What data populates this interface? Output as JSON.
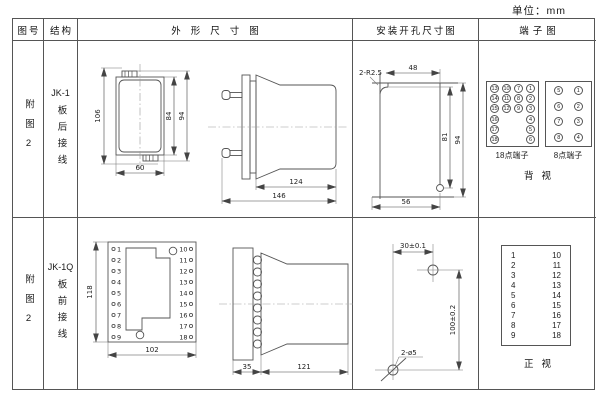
{
  "unit_label": "单位：mm",
  "headers": {
    "fig_no": "图号",
    "structure": "结构",
    "outline": "外形尺寸图",
    "install": "安装开孔尺寸图",
    "terminal": "端子图"
  },
  "row1": {
    "fig_no": "附图2",
    "model": "JK-1",
    "wiring": "板后接线",
    "front": {
      "h106": "106",
      "h84": "84",
      "h94": "94",
      "w60": "60"
    },
    "side": {
      "d124": "124",
      "d146": "146"
    },
    "install": {
      "radius_label": "2-R2.5",
      "d48": "48",
      "d81": "81",
      "d94": "94",
      "d56": "56"
    },
    "t18": {
      "label": "18点端子",
      "grid": [
        [
          "13",
          "10",
          "7",
          "1"
        ],
        [
          "14",
          "11",
          "8",
          "2"
        ],
        [
          "15",
          "12",
          "9",
          "3"
        ],
        [
          "16",
          "",
          "",
          "4"
        ],
        [
          "17",
          "",
          "",
          "5"
        ],
        [
          "18",
          "",
          "",
          "6"
        ]
      ]
    },
    "t8": {
      "label": "8点端子",
      "grid": [
        [
          "5",
          "1"
        ],
        [
          "6",
          "2"
        ],
        [
          "7",
          "3"
        ],
        [
          "8",
          "4"
        ]
      ]
    },
    "view_label": "背视"
  },
  "row2": {
    "fig_no": "附图2",
    "model": "JK-1Q",
    "wiring": "板前接线",
    "front": {
      "h118": "118",
      "w102": "102",
      "left": [
        "1",
        "2",
        "3",
        "4",
        "5",
        "6",
        "7",
        "8",
        "9"
      ],
      "right": [
        "10",
        "11",
        "12",
        "13",
        "14",
        "15",
        "16",
        "17",
        "18"
      ]
    },
    "side": {
      "d35": "35",
      "d121": "121"
    },
    "install": {
      "d30": "30±0.1",
      "d100": "100±0.2",
      "holes_label": "2-ø5"
    },
    "tbox": {
      "left": [
        "1",
        "2",
        "3",
        "4",
        "5",
        "6",
        "7",
        "8",
        "9"
      ],
      "right": [
        "10",
        "11",
        "12",
        "13",
        "14",
        "15",
        "16",
        "17",
        "18"
      ]
    },
    "view_label": "正视"
  }
}
